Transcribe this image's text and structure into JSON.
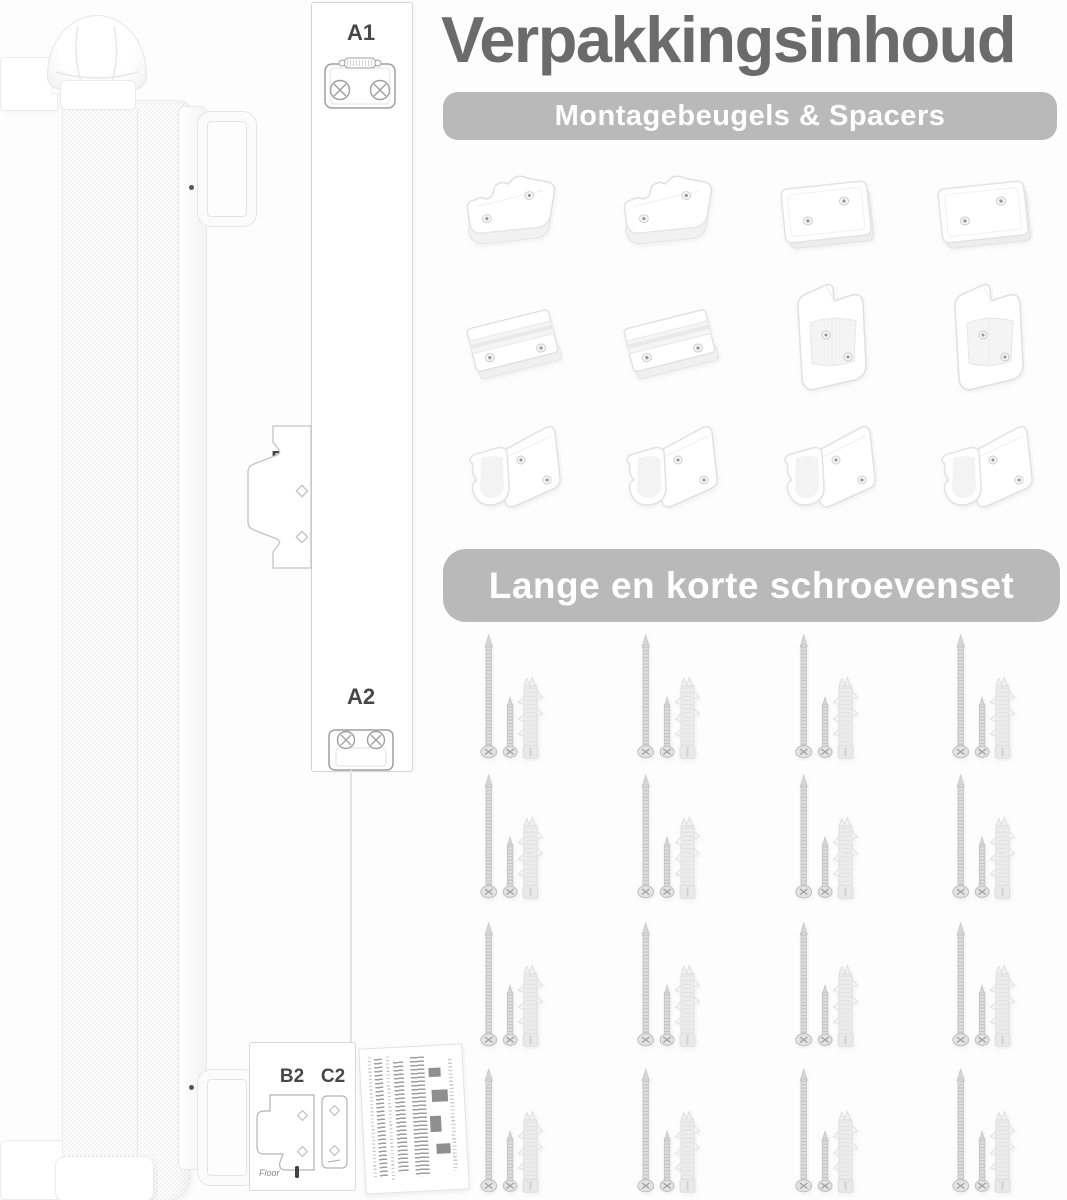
{
  "title": "Verpakkingsinhoud",
  "sections": {
    "brackets": {
      "banner": "Montagebeugels & Spacers",
      "rows": [
        [
          "wavy-plate",
          "wavy-plate",
          "flat-plate",
          "flat-plate"
        ],
        [
          "channel-bracket",
          "channel-bracket",
          "corner-bracket",
          "corner-bracket"
        ],
        [
          "hook-bracket",
          "hook-bracket",
          "hook-bracket",
          "hook-bracket"
        ]
      ]
    },
    "screws": {
      "banner": "Lange en korte schroevenset",
      "grid": {
        "rows": 4,
        "cols": 4
      },
      "set_items": [
        "long-screw",
        "short-screw",
        "wall-plug"
      ]
    }
  },
  "parts": {
    "a1": {
      "label": "A1"
    },
    "b1": {
      "label": "B1"
    },
    "a2": {
      "label": "A2"
    },
    "b2": {
      "label": "B2",
      "floor_text": "Floor"
    },
    "c2": {
      "label": "C2"
    }
  },
  "colors": {
    "background": "#fdfdfd",
    "title_text": "#6b6b6b",
    "banner_bg": "#b9b9b9",
    "banner_text": "#ffffff",
    "label_text": "#474747",
    "drawing_outline": "#9f9f9f",
    "metal": "#c9c9c9"
  }
}
